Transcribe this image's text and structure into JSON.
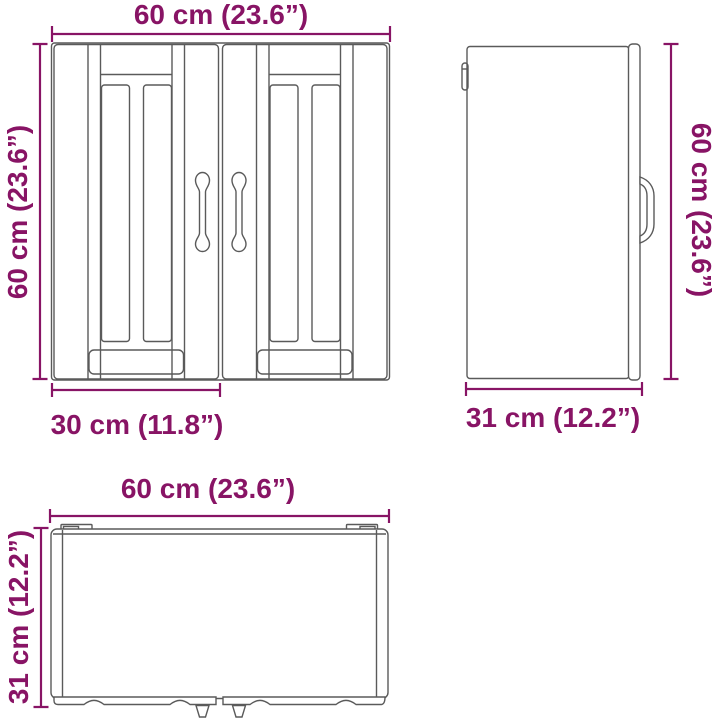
{
  "diagram_title": "Wall cabinet dimension drawing (front, side, top views)",
  "colors": {
    "dimension": "#881465",
    "outline": "#5a5a5a",
    "background": "#ffffff"
  },
  "front_view": {
    "width_label": "60 cm (23.6”)",
    "height_label": "60 cm (23.6”)",
    "door_width_label": "30 cm (11.8”)"
  },
  "side_view": {
    "height_label": "60 cm (23.6”)",
    "depth_label": "31 cm (12.2”)"
  },
  "top_view": {
    "width_label": "60 cm (23.6”)",
    "depth_label": "31 cm (12.2”)"
  }
}
